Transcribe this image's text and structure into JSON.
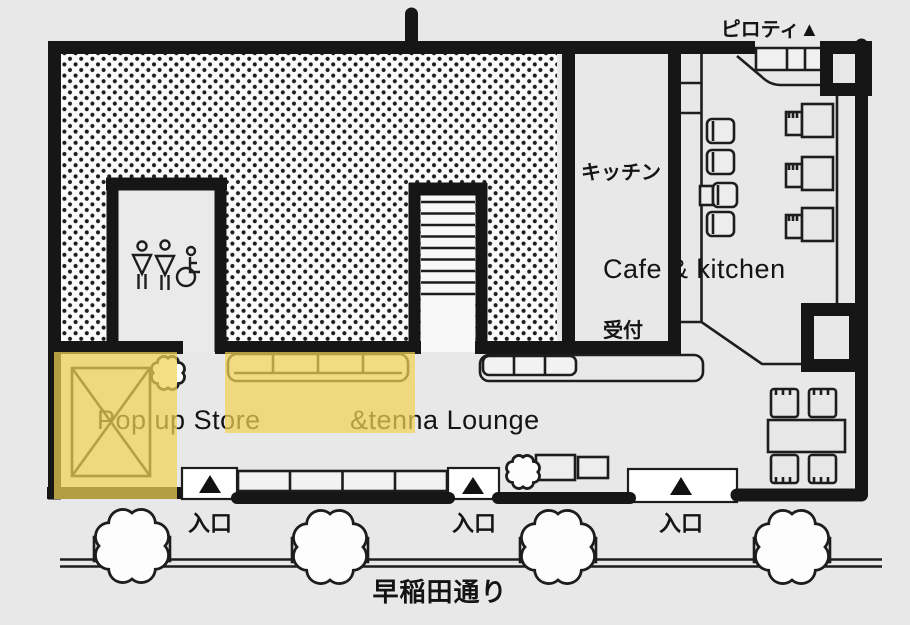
{
  "labels": {
    "piloti": "ピロティ▲",
    "kitchen": "キッチン",
    "reception": "受付",
    "cafe_kitchen": "Cafe & kitchen",
    "popup_store": "Pop up Store",
    "tenna_lounge": "&tenna Lounge",
    "street": "早稲田通り"
  },
  "entrances": [
    {
      "label": "入口"
    },
    {
      "label": "入口"
    },
    {
      "label": "入口"
    }
  ],
  "colors": {
    "background": "#e8e8e8",
    "wall": "#161616",
    "highlight": "rgba(240,210,85,0.72)",
    "dot": "#1c1c1c"
  }
}
